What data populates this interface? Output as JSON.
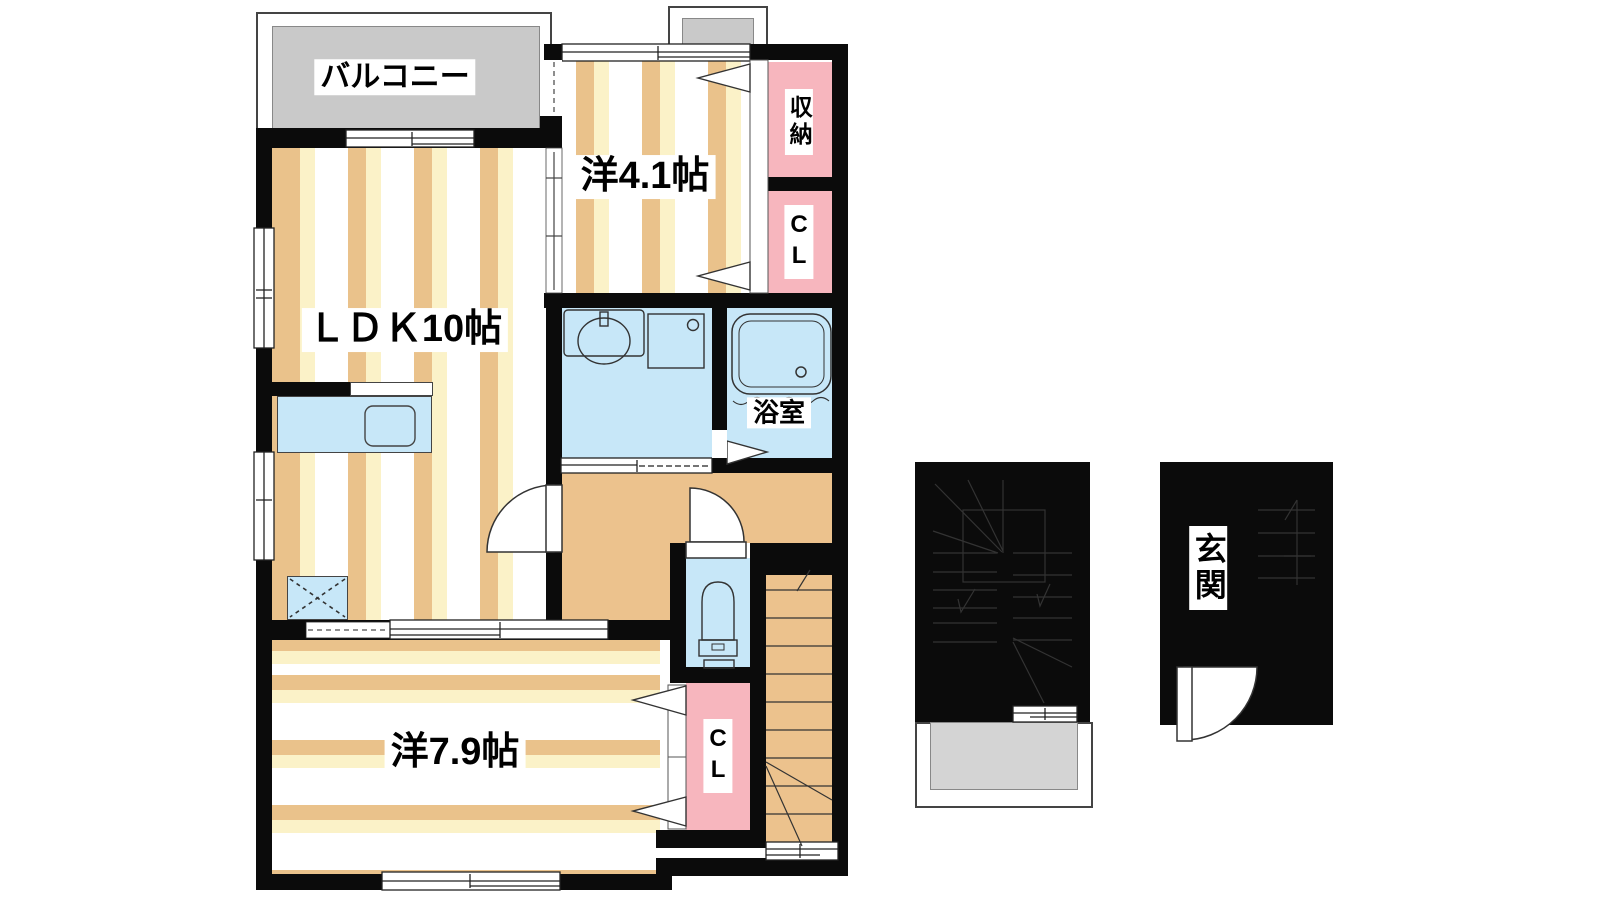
{
  "colors": {
    "wall": "#0b0b0b",
    "line": "#333333",
    "tan": "#eac28b",
    "cream": "#fbf2c8",
    "hall": "#ecc28d",
    "pink": "#f7b6be",
    "blue": "#c7e7f8",
    "gray": "#c9c9c9",
    "porch": "#d4d4d4"
  },
  "labels": {
    "balcony": "バルコニー",
    "room41": "洋4.1帖",
    "storage": "収納",
    "cl_upper": "CL",
    "ldk": "ＬＤＫ10帖",
    "bath": "浴室",
    "room79": "洋7.9帖",
    "cl_lower": "CL",
    "entrance": "玄関"
  },
  "rooms": [
    {
      "id": "balcony",
      "label": "バルコニー",
      "type": "balcony"
    },
    {
      "id": "bedroom-4-1",
      "label": "洋4.1帖",
      "type": "western-room"
    },
    {
      "id": "storage",
      "label": "収納",
      "type": "storage"
    },
    {
      "id": "closet-upper",
      "label": "CL",
      "type": "closet"
    },
    {
      "id": "ldk",
      "label": "ＬＤＫ10帖",
      "type": "living-dining-kitchen"
    },
    {
      "id": "bathroom",
      "label": "浴室",
      "type": "bath"
    },
    {
      "id": "bedroom-7-9",
      "label": "洋7.9帖",
      "type": "western-room"
    },
    {
      "id": "closet-lower",
      "label": "CL",
      "type": "closet"
    },
    {
      "id": "entrance",
      "label": "玄関",
      "type": "entrance"
    }
  ],
  "fixtures": [
    "kitchen-sink",
    "refrigerator-space",
    "washbasin",
    "washing-machine-pan",
    "bathtub",
    "toilet",
    "staircase"
  ]
}
